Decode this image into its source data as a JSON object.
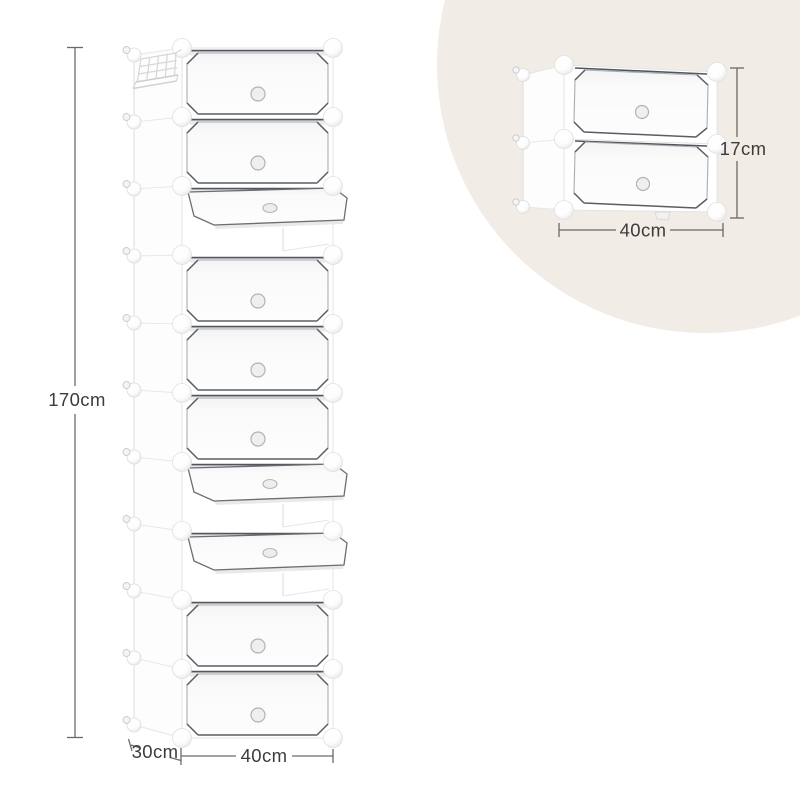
{
  "illustration": {
    "background_color": "#ffffff",
    "accent_circle_color": "#f1ece5",
    "dimension_line_color": "#6a6a6a",
    "label_text_color": "#3c3c3c",
    "outline_dark": "#53575c",
    "outline_light": "#a9aeb4"
  },
  "main_unit": {
    "rows": [
      "closed",
      "closed",
      "open",
      "closed",
      "closed",
      "closed",
      "open",
      "open",
      "closed",
      "closed"
    ],
    "side_basket": true,
    "labels": {
      "height": "170cm",
      "depth": "30cm",
      "width": "40cm"
    }
  },
  "inset_unit": {
    "rows": [
      "closed",
      "closed"
    ],
    "labels": {
      "height": "17cm",
      "width": "40cm"
    }
  }
}
